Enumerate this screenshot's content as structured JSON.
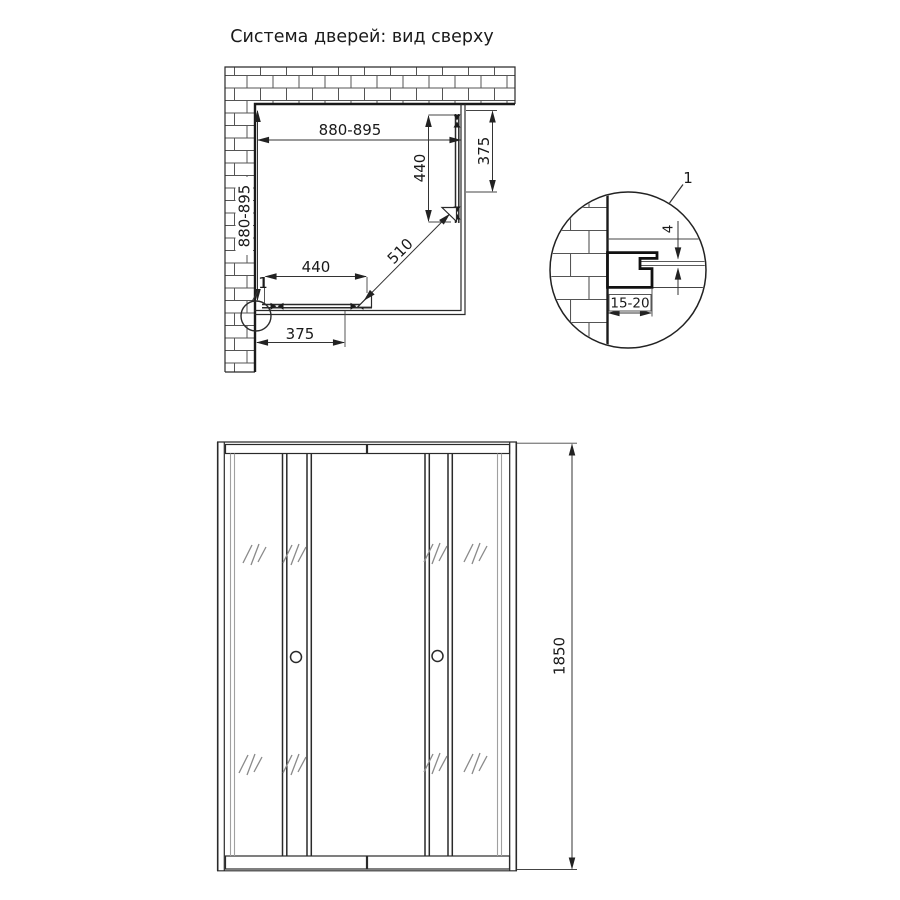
{
  "title": "Система дверей: вид сверху",
  "plan": {
    "width_dim": "880-895",
    "depth_dim": "880-895",
    "right_door_width": "440",
    "right_panel_width": "375",
    "bottom_door_width": "440",
    "bottom_panel_width": "375",
    "diagonal_opening": "510",
    "detail_ref": "1"
  },
  "detail": {
    "callout_label": "1",
    "profile_depth": "15-20",
    "glass_thickness": "4"
  },
  "front": {
    "height_dim": "1850"
  }
}
